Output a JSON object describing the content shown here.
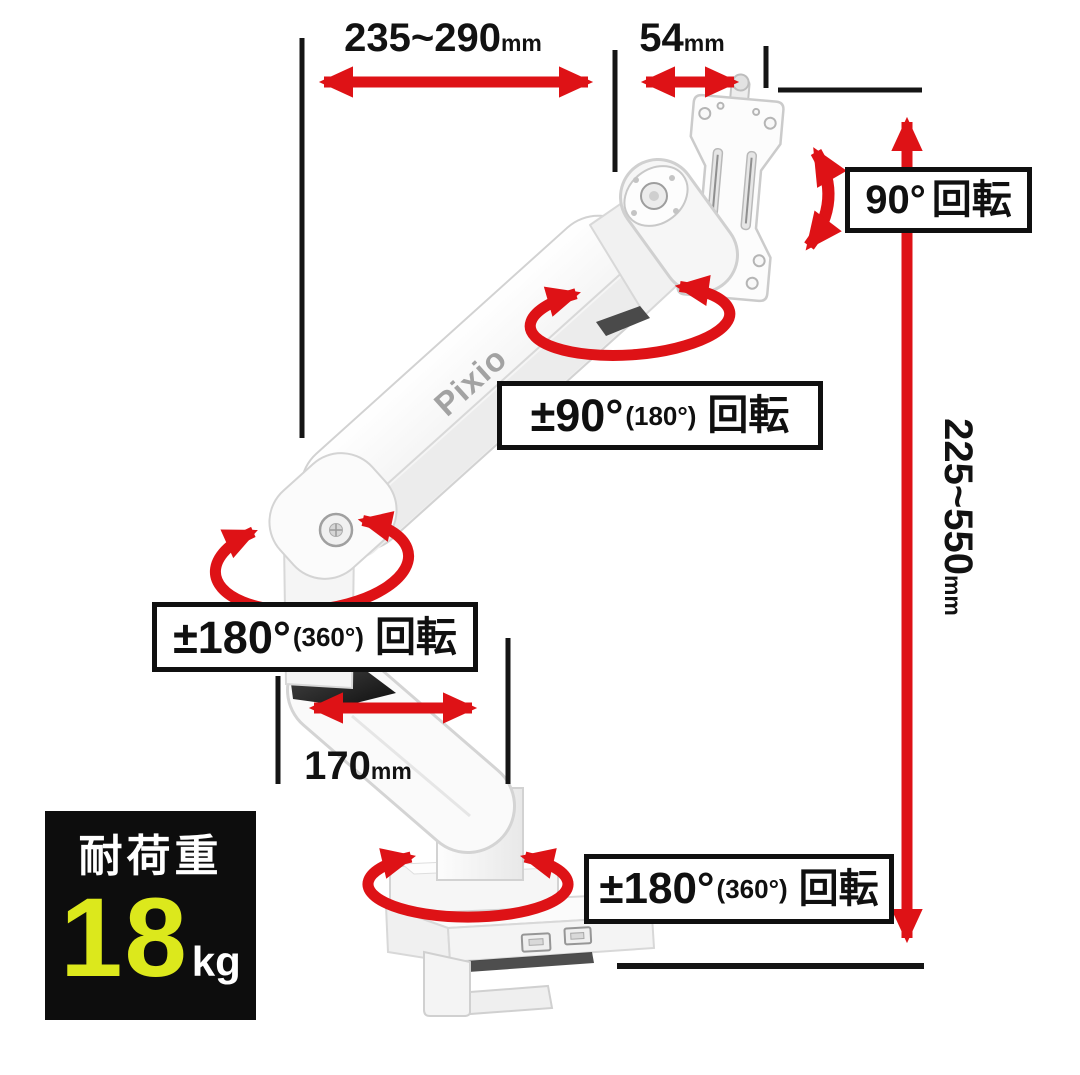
{
  "product": {
    "brand_logo": "Pixio"
  },
  "dimensions": {
    "arm_extension": {
      "value": "235~290",
      "unit": "mm"
    },
    "vesa_depth": {
      "value": "54",
      "unit": "mm"
    },
    "height_range": {
      "value": "225~550",
      "unit": "mm"
    },
    "base_arm_length": {
      "value": "170",
      "unit": "mm"
    }
  },
  "rotations": {
    "monitor_pivot": {
      "angle": "90°",
      "paren": "",
      "label": "回転"
    },
    "upper_arm_swivel": {
      "angle": "±90°",
      "paren": "(180°)",
      "label": "回転"
    },
    "elbow_swivel": {
      "angle": "±180°",
      "paren": "(360°)",
      "label": "回転"
    },
    "base_swivel": {
      "angle": "±180°",
      "paren": "(360°)",
      "label": "回転"
    }
  },
  "load_capacity": {
    "label": "耐荷重",
    "value": "18",
    "unit": "kg"
  },
  "colors": {
    "accent_red": "#de1216",
    "highlight_yellow": "#dce81c",
    "panel_black": "#0d0d0d"
  }
}
